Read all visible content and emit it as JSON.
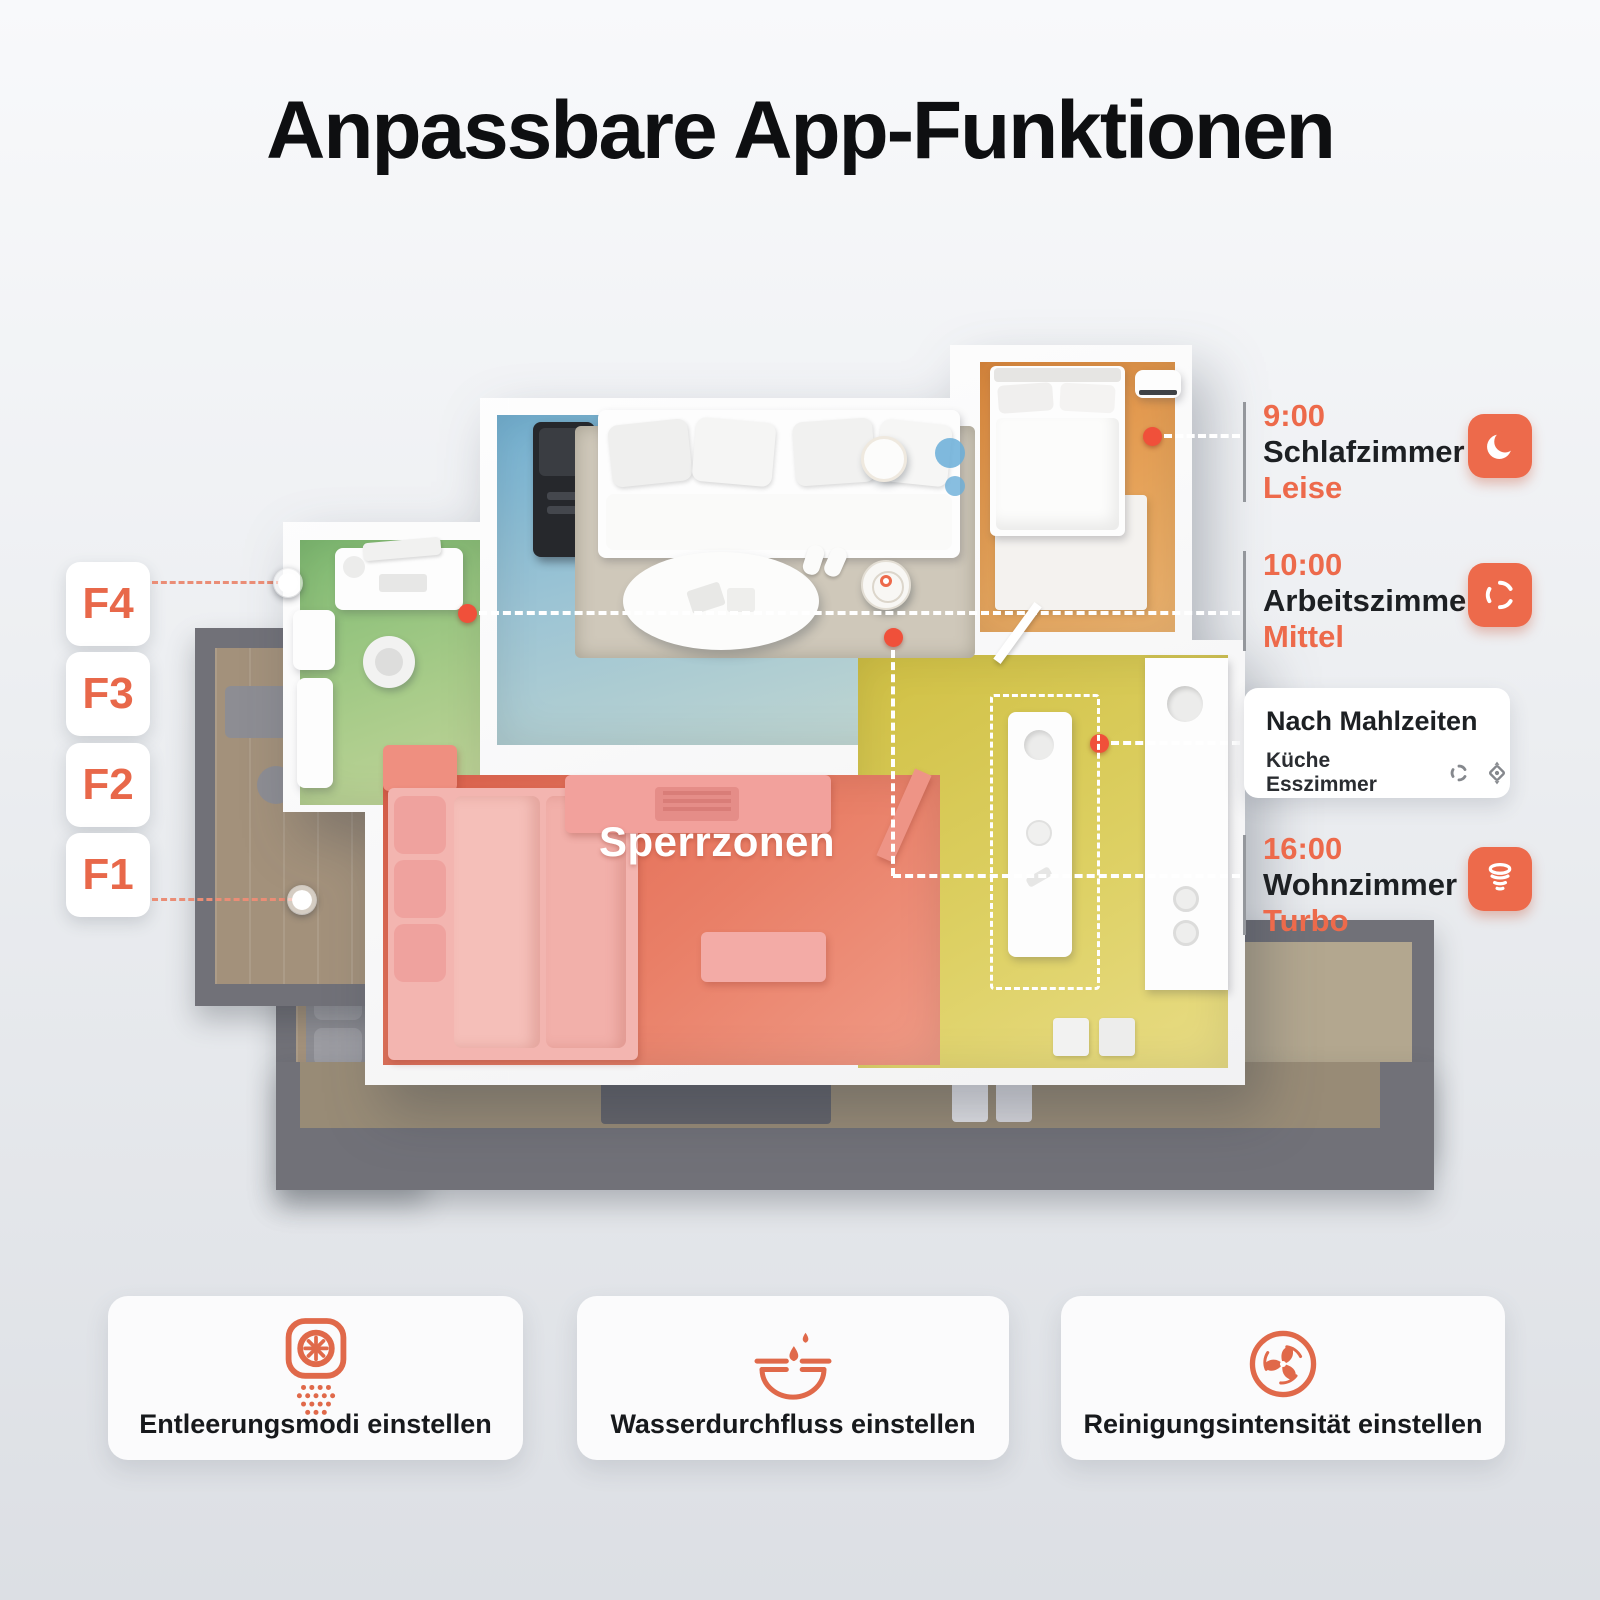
{
  "title": "Anpassbare App-Funktionen",
  "floors": [
    {
      "label": "F4"
    },
    {
      "label": "F3"
    },
    {
      "label": "F2"
    },
    {
      "label": "F1"
    }
  ],
  "map": {
    "no_go_zone_label": "Sperrzonen"
  },
  "schedules": [
    {
      "time": "9:00",
      "room": "Schlafzimmer",
      "mode": "Leise",
      "icon": "moon-icon"
    },
    {
      "time": "10:00",
      "room": "Arbeitszimmer",
      "mode": "Mittel",
      "icon": "fan-swirl-icon"
    },
    {
      "time": "16:00",
      "room": "Wohnzimmer",
      "mode": "Turbo",
      "icon": "turbo-spiral-icon"
    }
  ],
  "meal_schedule": {
    "title": "Nach Mahlzeiten",
    "rooms": "Küche Esszimmer",
    "icons": [
      "fan-swirl-icon",
      "mop-flow-icon"
    ]
  },
  "features": [
    {
      "label": "Entleerungsmodi einstellen",
      "icon": "auto-empty-icon"
    },
    {
      "label": "Wasserdurchfluss einstellen",
      "icon": "water-flow-icon"
    },
    {
      "label": "Reinigungsintensität einstellen",
      "icon": "cleaning-intensity-icon"
    }
  ],
  "colors": {
    "accent": "#ED6A4B",
    "living_room": "#8FBCD4",
    "office": "#96C383",
    "bedroom": "#E19350",
    "kitchen": "#D9CB58",
    "no_go_zone": "#E4705C",
    "underfloor": "#717178"
  }
}
